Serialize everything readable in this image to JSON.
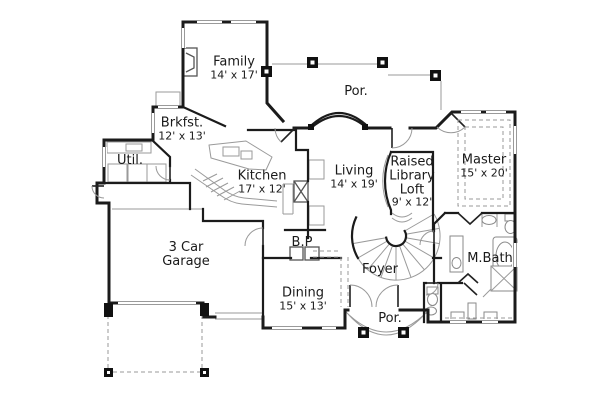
{
  "page": {
    "background": "#ffffff"
  },
  "plan": {
    "type": "floor-plan",
    "colors": {
      "wall": "#1b1b1b",
      "detail": "#9a9a9a",
      "text": "#1a1a1a"
    },
    "rooms": [
      {
        "id": "family",
        "lines": [
          "Family"
        ],
        "dims": "14' x 17'",
        "x": 234,
        "y": 68
      },
      {
        "id": "porch-top",
        "lines": [
          "Por."
        ],
        "dims": "",
        "x": 356,
        "y": 92
      },
      {
        "id": "breakfast",
        "lines": [
          "Brkfst."
        ],
        "dims": "12' x 13'",
        "x": 182,
        "y": 129
      },
      {
        "id": "utility",
        "lines": [
          "Util."
        ],
        "dims": "",
        "x": 130,
        "y": 161
      },
      {
        "id": "kitchen",
        "lines": [
          "Kitchen"
        ],
        "dims": "17' x 12'",
        "x": 262,
        "y": 182
      },
      {
        "id": "living",
        "lines": [
          "Living"
        ],
        "dims": "14' x 19'",
        "x": 354,
        "y": 177
      },
      {
        "id": "library",
        "lines": [
          "Raised",
          "Library",
          "Loft"
        ],
        "dims": "9' x 12'",
        "x": 412,
        "y": 182
      },
      {
        "id": "master",
        "lines": [
          "Master"
        ],
        "dims": "15' x 20'",
        "x": 484,
        "y": 166
      },
      {
        "id": "garage",
        "lines": [
          "3 Car",
          "Garage"
        ],
        "dims": "",
        "x": 186,
        "y": 255
      },
      {
        "id": "butlers-pantry",
        "lines": [
          "B.P"
        ],
        "dims": "",
        "x": 302,
        "y": 243
      },
      {
        "id": "dining",
        "lines": [
          "Dining"
        ],
        "dims": "15' x 13'",
        "x": 303,
        "y": 299
      },
      {
        "id": "foyer",
        "lines": [
          "Foyer"
        ],
        "dims": "",
        "x": 380,
        "y": 270
      },
      {
        "id": "porch-bottom",
        "lines": [
          "Por."
        ],
        "dims": "",
        "x": 390,
        "y": 319
      },
      {
        "id": "master-bath",
        "lines": [
          "M.Bath"
        ],
        "dims": "",
        "x": 490,
        "y": 259
      }
    ]
  }
}
